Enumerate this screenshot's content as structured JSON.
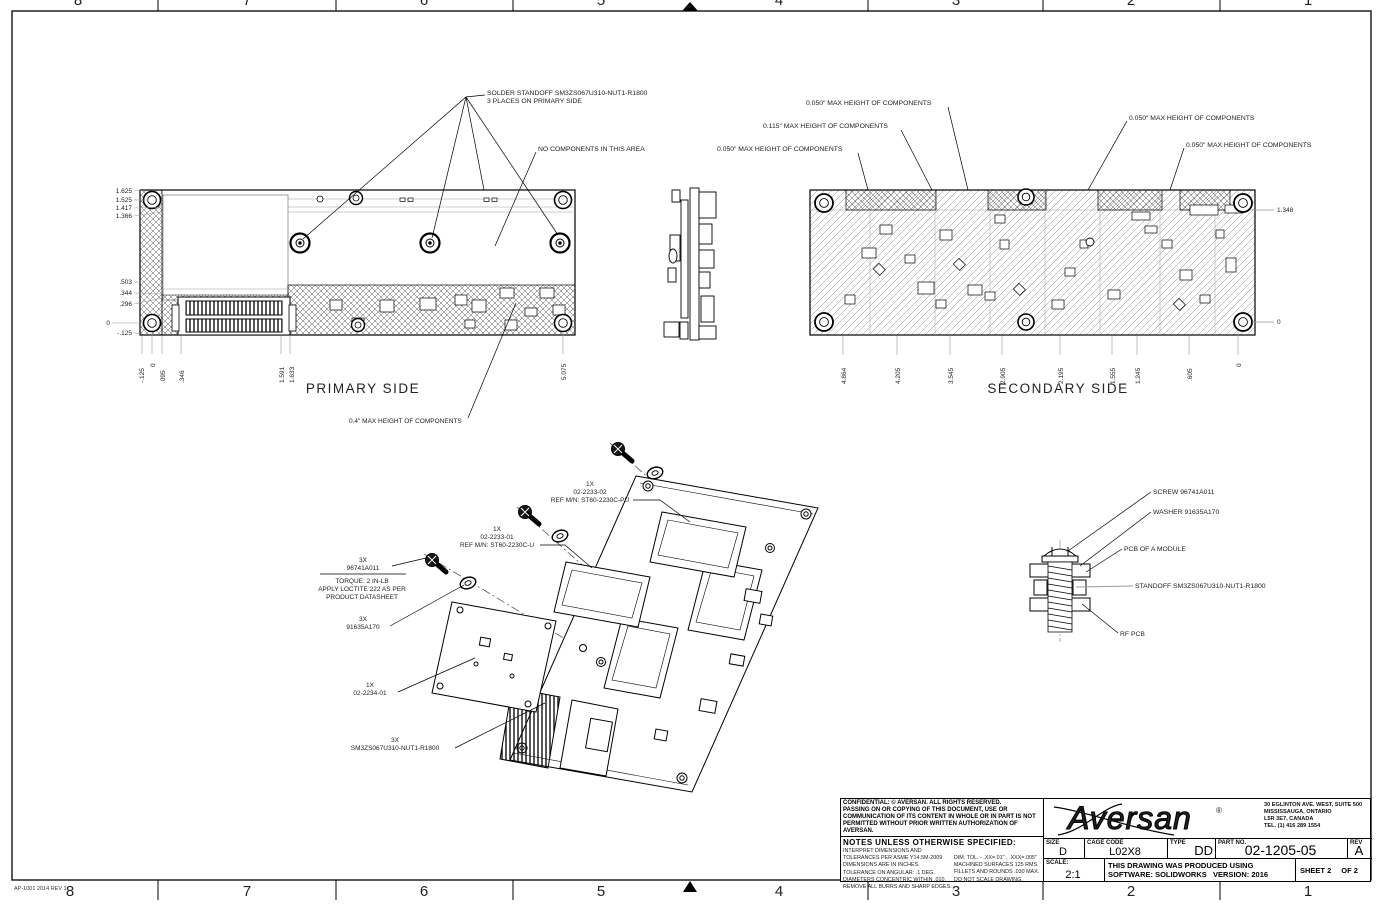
{
  "border": {
    "zones": [
      "8",
      "7",
      "6",
      "5",
      "4",
      "3",
      "2",
      "1"
    ],
    "stamp": "AP-1001 2014 REV 1"
  },
  "primary": {
    "title": "PRIMARY SIDE",
    "callout_standoff_1": "SOLDER STANDOFF SM3ZS067U310-NUT1-R1800",
    "callout_standoff_2": "3 PLACES ON PRIMARY SIDE",
    "callout_no_components": "NO COMPONENTS IN THIS AREA",
    "callout_max_height": "0.4\" MAX HEIGHT OF COMPONENTS",
    "dims_left": [
      "1.625",
      "1.525",
      "1.417",
      "1.366",
      ".503",
      ".344",
      ".296",
      "0",
      "-.125"
    ],
    "dims_bottom": [
      "-.125",
      "0",
      ".095",
      ".346",
      "1.591",
      "1.633",
      "5.075"
    ]
  },
  "secondary": {
    "title": "SECONDARY SIDE",
    "callouts": [
      "0.050\" MAX HEIGHT OF COMPONENTS",
      "0.115\" MAX HEIGHT OF COMPONENTS",
      "0.050\" MAX HEIGHT OF COMPONENTS",
      "0.050\" MAX HEIGHT OF COMPONENTS",
      "0.050\" MAX HEIGHT OF COMPONENTS"
    ],
    "dims_right": [
      "1.348",
      "0"
    ],
    "dims_bottom": [
      "4.864",
      "4.205",
      "3.545",
      "2.905",
      "2.195",
      "1.555",
      "1.245",
      ".605",
      "0"
    ]
  },
  "exploded": {
    "screw_qty": "3X",
    "screw_pn": "96741A011",
    "torque_1": "TORQUE: 2 IN-LB",
    "torque_2": "APPLY LOCTITE 222 AS PER",
    "torque_3": "PRODUCT DATASHEET",
    "washer_qty": "3X",
    "washer_pn": "91635A170",
    "module_qty": "1X",
    "module_pn": "02-2234-01",
    "conn_pu_qty": "1X",
    "conn_pu_pn": "02-2233-02",
    "conn_pu_ref": "REF M/N: ST60-2230C-PU",
    "conn_u_qty": "1X",
    "conn_u_pn": "02-2233-01",
    "conn_u_ref": "REF M/N: ST60-2230C-U",
    "nut_qty": "3X",
    "nut_pn": "SM3ZS067U310-NUT1-R1800"
  },
  "detail": {
    "screw": "SCREW 96741A011",
    "washer": "WASHER 91635A170",
    "pcb_module": "PCB OF A MODULE",
    "standoff": "STANDOFF SM3ZS067U310-NUT1-R1800",
    "rf_pcb": "RF PCB"
  },
  "titleblock": {
    "confidential": [
      "CONFIDENTIAL: © AVERSAN. ALL RIGHTS RESERVED.",
      "PASSING ON OR COPYING OF THIS DOCUMENT, USE OR",
      "COMMUNICATION OF ITS CONTENT IN WHOLE OR IN PART IS NOT",
      "PERMITTED WITHOUT PRIOR WRITTEN AUTHORIZATION OF AVERSAN."
    ],
    "notes_title": "NOTES UNLESS OTHERWISE SPECIFIED:",
    "notes_left": [
      "INTERPRET DIMENSIONS AND TOLERANCES PER ASME Y14.5M-2009",
      "DIMENSIONS ARE IN INCHES.",
      "TOLERANCE ON ANGULAR:  .1 DEG.",
      "DIAMETERS CONCENTRIC WITHIN .010.",
      "REMOVE ALL BURRS AND SHARP EDGES."
    ],
    "notes_right": [
      "DIM. TOL. - .XX=.01\" , .XXX=.005\"",
      "MACHINED SURFACES 125 RMS.",
      "FILLETS AND ROUNDS .030 MAX.",
      "DO NOT SCALE DRAWING."
    ],
    "company": "Aversan",
    "company_mark": "®",
    "address": [
      "30 EGLINTON AVE. WEST, SUITE 500",
      "MISSISSAUGA, ONTARIO",
      "L5R 3E7, CANADA",
      "TEL. (1) 416 289 1554"
    ],
    "size_label": "SIZE",
    "size_value": "D",
    "cage_label": "CAGE CODE",
    "cage_value": "L02X8",
    "type_label": "TYPE",
    "type_value": "DD",
    "part_label": "PART NO.",
    "part_value": "02-1205-05",
    "rev_label": "REV",
    "rev_value": "A",
    "scale_label": "SCALE:",
    "scale_value": "2:1",
    "produced_1": "THIS DRAWING WAS PRODUCED USING",
    "produced_2": "SOFTWARE: SOLIDWORKS",
    "produced_3": "VERSION: 2016",
    "sheet_label": "SHEET 2",
    "sheet_of": "OF 2"
  }
}
